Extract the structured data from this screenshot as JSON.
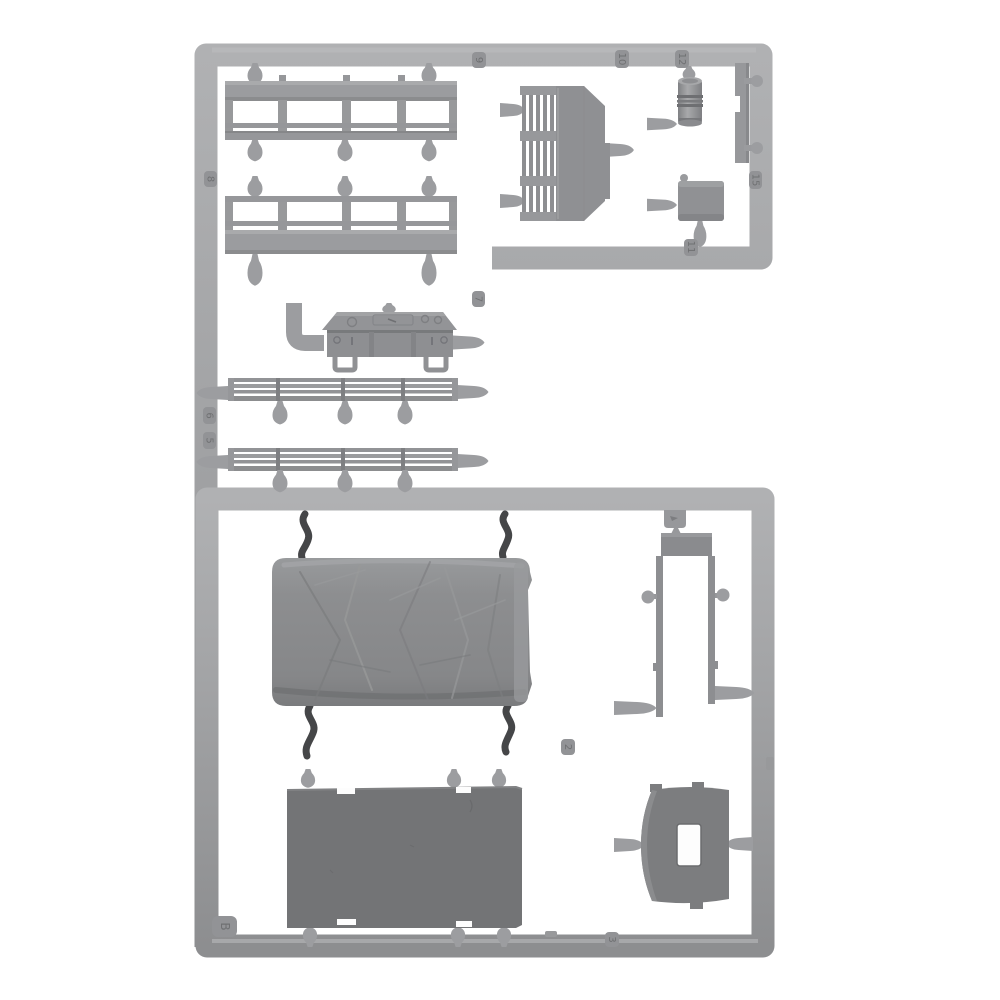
{
  "image": {
    "type": "product-photo",
    "subject": "injection-molded plastic model kit sprue (parts tree) of grey truck parts on a white background",
    "background_color": "#ffffff"
  },
  "colors": {
    "runner_grey": "#a1a2a4",
    "runner_highlight": "#b2b3b5",
    "runner_shadow": "#8a8b8d",
    "part_grey": "#97989a",
    "tarp_grey": "#8a8b8d",
    "floor_panel_grey": "#737476",
    "cab_panel_grey": "#7c7d7f",
    "dark_gate": "#454648",
    "tag_plate": "#929396",
    "tag_digit": "#6f7072",
    "white_background": "#ffffff"
  },
  "sprue": {
    "letter_tag": "B",
    "part_number_tags": [
      {
        "label": "9"
      },
      {
        "label": "10"
      },
      {
        "label": "12"
      },
      {
        "label": "15"
      },
      {
        "label": "11"
      },
      {
        "label": "8"
      },
      {
        "label": "7"
      },
      {
        "label": "6"
      },
      {
        "label": "5"
      },
      {
        "label": "2"
      },
      {
        "label": "3"
      },
      {
        "label": "B"
      }
    ],
    "parts": [
      {
        "name": "cargo-bed-side-rail-upper"
      },
      {
        "name": "cargo-bed-side-rail-lower"
      },
      {
        "name": "tool-box-with-lid"
      },
      {
        "name": "radiator-with-fins"
      },
      {
        "name": "air-cleaner-cylinder"
      },
      {
        "name": "mounting-bar"
      },
      {
        "name": "storage-box"
      },
      {
        "name": "tilt-rail-upper"
      },
      {
        "name": "tilt-rail-lower"
      },
      {
        "name": "canvas-tilt-cover"
      },
      {
        "name": "cargo-floor-panel"
      },
      {
        "name": "frame-bracket-u-shape"
      },
      {
        "name": "cab-rear-panel-with-window"
      }
    ]
  }
}
